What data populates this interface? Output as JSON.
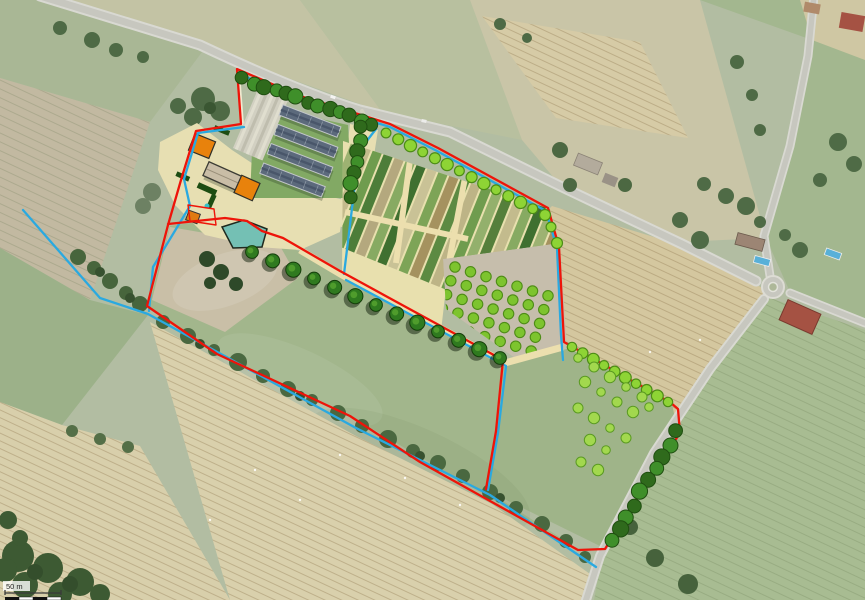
{
  "map": {
    "title": "Aerial site plan - farm and market-garden project",
    "scale_label": "50 m"
  },
  "colors": {
    "boundary_red": "#ee1409",
    "water_blue": "#2aa9e0",
    "hedge_green": "#3f8f2a",
    "hedge_dark": "#2f6a1c",
    "tree_green": "#8ed435",
    "tree_ring": "#4c8c16",
    "orchard_tree": "#7dc42e",
    "scattered_tree": "#a2d84e",
    "building_roof": "#5c6a7c",
    "building_accent": "#e8820c",
    "pond_teal": "#74c0b4",
    "path_cream": "#ecdfae",
    "yard_cream": "#e7dfb2"
  },
  "features": {
    "tree_rows": [
      {
        "name": "roadside-tree-row",
        "x1": 386,
        "y1": 133,
        "x2": 545,
        "y2": 215,
        "n": 14,
        "r": 5.5,
        "style": "round"
      },
      {
        "name": "roadside-tree-row-end",
        "x1": 551,
        "y1": 227,
        "x2": 557,
        "y2": 243,
        "n": 2,
        "r": 5.5,
        "style": "round"
      },
      {
        "name": "orchard-edge-tree-row",
        "x1": 572,
        "y1": 347,
        "x2": 668,
        "y2": 402,
        "n": 10,
        "r": 5.3,
        "style": "round"
      },
      {
        "name": "hedge-top-northwest",
        "x1": 243,
        "y1": 79,
        "x2": 372,
        "y2": 124,
        "n": 13,
        "r": 6,
        "style": "hedge"
      },
      {
        "name": "hedge-buildings-east",
        "x1": 362,
        "y1": 128,
        "x2": 350,
        "y2": 196,
        "n": 7,
        "r": 6,
        "style": "hedge"
      },
      {
        "name": "road-hedgerow-southeast",
        "x1": 677,
        "y1": 432,
        "x2": 612,
        "y2": 541,
        "n": 10,
        "r": 6.5,
        "style": "hedge"
      },
      {
        "name": "field-boundary-tree-line",
        "x1": 252,
        "y1": 252,
        "x2": 500,
        "y2": 358,
        "n": 13,
        "r": 7,
        "style": "shadow"
      }
    ],
    "orchard_grid": {
      "rows": 5,
      "cols": 7,
      "x0": 455,
      "y0": 267,
      "dx": 15.5,
      "dy": 4.8,
      "rx": -4.2,
      "ry": 13.8,
      "r": 5.2
    },
    "scattered_trees": [
      [
        578,
        358
      ],
      [
        594,
        367
      ],
      [
        610,
        377
      ],
      [
        626,
        387
      ],
      [
        642,
        397
      ],
      [
        585,
        382
      ],
      [
        601,
        392
      ],
      [
        617,
        402
      ],
      [
        633,
        412
      ],
      [
        649,
        407
      ],
      [
        578,
        408
      ],
      [
        594,
        418
      ],
      [
        610,
        428
      ],
      [
        626,
        438
      ],
      [
        590,
        440
      ],
      [
        606,
        450
      ],
      [
        581,
        462
      ],
      [
        598,
        470
      ]
    ],
    "pasture_dots": [
      [
        255,
        470
      ],
      [
        300,
        500
      ],
      [
        210,
        520
      ],
      [
        405,
        478
      ],
      [
        460,
        505
      ],
      [
        650,
        352
      ],
      [
        700,
        340
      ],
      [
        340,
        455
      ]
    ],
    "beds_strip_colors": [
      "#9db272",
      "#c3bb8d",
      "#6f9c4e",
      "#4d7d39",
      "#b4a87e",
      "#87aa62",
      "#3f7030",
      "#c9c296",
      "#7da457",
      "#a5925f",
      "#5c8a42",
      "#bdb486",
      "#6f9c4e",
      "#93b06c",
      "#557f3b",
      "#c3bb8d",
      "#87aa62",
      "#3f7030",
      "#9db272",
      "#a5925f"
    ]
  }
}
